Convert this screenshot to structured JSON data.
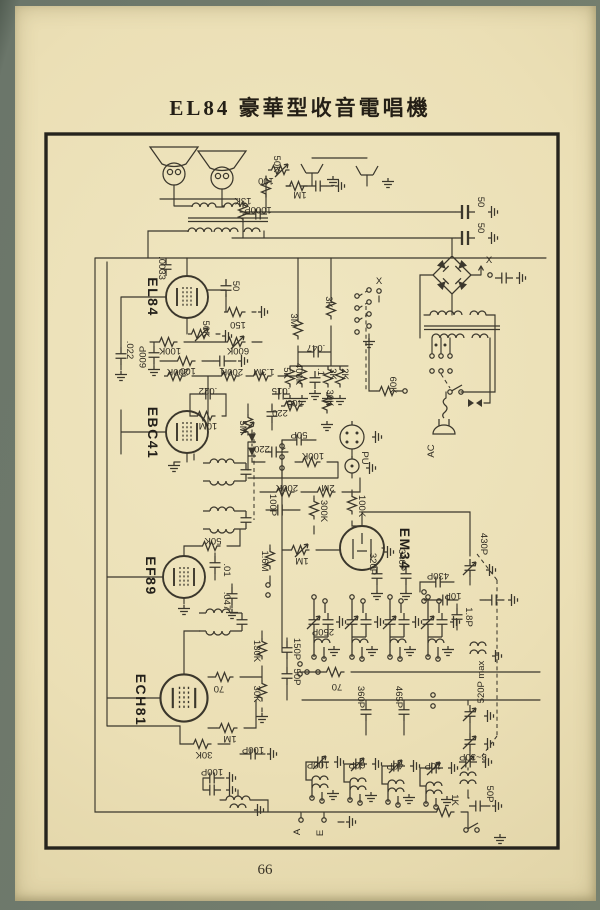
{
  "page": {
    "title": "EL84 豪華型收音電唱機",
    "page_number": "66"
  },
  "colors": {
    "paper": "#ebdfb5",
    "ink": "#3b372c",
    "frame": "#26241d"
  },
  "schematic": {
    "tube_labels": [
      {
        "t": "EL84",
        "x": 148,
        "y": 297
      },
      {
        "t": "EBC41",
        "x": 148,
        "y": 433
      },
      {
        "t": "EF89",
        "x": 146,
        "y": 576
      },
      {
        "t": "ECH81",
        "x": 136,
        "y": 700
      },
      {
        "t": "EM34",
        "x": 400,
        "y": 549
      }
    ],
    "value_labels": [
      {
        "t": "50K",
        "x": 274,
        "y": 164,
        "r": 90
      },
      {
        "t": "100",
        "x": 266,
        "y": 178,
        "r": 180
      },
      {
        "t": "13K",
        "x": 243,
        "y": 198,
        "r": 180
      },
      {
        "t": "1000P",
        "x": 258,
        "y": 207,
        "r": 180
      },
      {
        "t": "1M",
        "x": 300,
        "y": 192,
        "r": 180
      },
      {
        "t": ".0033",
        "x": 159,
        "y": 268,
        "r": 90
      },
      {
        "t": "50",
        "x": 478,
        "y": 202,
        "r": 90
      },
      {
        "t": "50",
        "x": 478,
        "y": 228,
        "r": 90
      },
      {
        "t": "X",
        "x": 489,
        "y": 263,
        "r": 0
      },
      {
        "t": "X",
        "x": 379,
        "y": 284,
        "r": 0
      },
      {
        "t": "AC",
        "x": 434,
        "y": 451,
        "r": -90
      },
      {
        "t": "50",
        "x": 233,
        "y": 286,
        "r": 90
      },
      {
        "t": "150",
        "x": 238,
        "y": 322,
        "r": 180
      },
      {
        "t": "50K",
        "x": 203,
        "y": 329,
        "r": 90
      },
      {
        "t": "100K",
        "x": 170,
        "y": 348,
        "r": 180
      },
      {
        "t": "600K",
        "x": 238,
        "y": 348,
        "r": 180
      },
      {
        "t": ".022",
        "x": 127,
        "y": 350,
        "r": 90
      },
      {
        "t": "600P",
        "x": 146,
        "y": 357,
        "r": -90
      },
      {
        "t": "100",
        "x": 188,
        "y": 368,
        "r": 180
      },
      {
        "t": "1",
        "x": 222,
        "y": 368,
        "r": 180
      },
      {
        "t": "3M",
        "x": 291,
        "y": 320,
        "r": 90
      },
      {
        "t": "3K",
        "x": 326,
        "y": 302,
        "r": 90
      },
      {
        "t": ".047",
        "x": 316,
        "y": 345,
        "r": 180
      },
      {
        "t": "5K",
        "x": 284,
        "y": 373,
        "r": 90
      },
      {
        "t": "400K",
        "x": 296,
        "y": 374,
        "r": 90
      },
      {
        "t": ".1",
        "x": 318,
        "y": 372,
        "r": 90
      },
      {
        "t": "3K",
        "x": 330,
        "y": 374,
        "r": 90
      },
      {
        "t": "2K",
        "x": 342,
        "y": 374,
        "r": 90
      },
      {
        "t": "60K",
        "x": 390,
        "y": 385,
        "r": 90
      },
      {
        "t": "200K",
        "x": 178,
        "y": 369,
        "r": 180
      },
      {
        "t": "200K",
        "x": 232,
        "y": 369,
        "r": 180
      },
      {
        "t": ".022",
        "x": 208,
        "y": 388,
        "r": 180
      },
      {
        "t": "10M",
        "x": 208,
        "y": 423,
        "r": 180
      },
      {
        "t": "1.3M",
        "x": 264,
        "y": 369,
        "r": 180
      },
      {
        "t": "220",
        "x": 280,
        "y": 410,
        "r": 180
      },
      {
        "t": "220",
        "x": 262,
        "y": 446,
        "r": 180
      },
      {
        "t": "5M",
        "x": 240,
        "y": 427,
        "r": 90,
        "fs": 11
      },
      {
        "t": ".015",
        "x": 281,
        "y": 388,
        "r": 180
      },
      {
        "t": "400",
        "x": 295,
        "y": 400,
        "r": 180
      },
      {
        "t": "30K",
        "x": 327,
        "y": 398,
        "r": 90
      },
      {
        "t": "50P",
        "x": 299,
        "y": 432,
        "r": 180
      },
      {
        "t": "100K",
        "x": 313,
        "y": 453,
        "r": 180
      },
      {
        "t": "PU",
        "x": 362,
        "y": 458,
        "r": 90
      },
      {
        "t": "2M",
        "x": 328,
        "y": 485,
        "r": 180
      },
      {
        "t": "200K",
        "x": 287,
        "y": 485,
        "r": 180
      },
      {
        "t": "300K",
        "x": 321,
        "y": 511,
        "r": 90
      },
      {
        "t": "100K",
        "x": 359,
        "y": 506,
        "r": 90
      },
      {
        "t": "100P",
        "x": 270,
        "y": 505,
        "r": 90
      },
      {
        "t": "50K",
        "x": 213,
        "y": 538,
        "r": 180
      },
      {
        "t": "1.6M",
        "x": 262,
        "y": 561,
        "r": 90
      },
      {
        "t": "1M",
        "x": 302,
        "y": 558,
        "r": 180
      },
      {
        "t": ".01",
        "x": 224,
        "y": 570,
        "r": 90
      },
      {
        "t": ".047",
        "x": 224,
        "y": 601,
        "r": 90
      },
      {
        "t": "320P",
        "x": 370,
        "y": 564,
        "r": 90
      },
      {
        "t": "340P",
        "x": 399,
        "y": 560,
        "r": 90
      },
      {
        "t": "430P",
        "x": 481,
        "y": 544,
        "r": 90
      },
      {
        "t": "430P",
        "x": 438,
        "y": 573,
        "r": 180
      },
      {
        "t": "10P",
        "x": 453,
        "y": 593,
        "r": 180
      },
      {
        "t": "1.8P",
        "x": 466,
        "y": 617,
        "r": 90
      },
      {
        "t": "250P",
        "x": 323,
        "y": 629,
        "r": 180
      },
      {
        "t": "130K",
        "x": 254,
        "y": 651,
        "r": 90
      },
      {
        "t": "150P",
        "x": 294,
        "y": 649,
        "r": 90
      },
      {
        "t": "50P",
        "x": 294,
        "y": 677,
        "r": 90
      },
      {
        "t": "70",
        "x": 219,
        "y": 686,
        "r": 180
      },
      {
        "t": "30K",
        "x": 254,
        "y": 694,
        "r": 90
      },
      {
        "t": "1M",
        "x": 230,
        "y": 736,
        "r": 180
      },
      {
        "t": "30K",
        "x": 204,
        "y": 752,
        "r": 180
      },
      {
        "t": "100P",
        "x": 212,
        "y": 769,
        "r": 180
      },
      {
        "t": "100P",
        "x": 253,
        "y": 747,
        "r": 180
      },
      {
        "t": "70",
        "x": 337,
        "y": 684,
        "r": 180
      },
      {
        "t": "360P",
        "x": 358,
        "y": 697,
        "r": 90
      },
      {
        "t": "465P",
        "x": 396,
        "y": 697,
        "r": 90
      },
      {
        "t": "520P max",
        "x": 484,
        "y": 682,
        "r": -90
      },
      {
        "t": "100P",
        "x": 318,
        "y": 762,
        "r": 180
      },
      {
        "t": "60P",
        "x": 357,
        "y": 762,
        "r": 180
      },
      {
        "t": "40P",
        "x": 395,
        "y": 763,
        "r": 180
      },
      {
        "t": "10P",
        "x": 433,
        "y": 763,
        "r": 180
      },
      {
        "t": "3~30P",
        "x": 473,
        "y": 754,
        "r": 180
      },
      {
        "t": "50P",
        "x": 487,
        "y": 794,
        "r": 90
      },
      {
        "t": "1K",
        "x": 452,
        "y": 800,
        "r": 90
      },
      {
        "t": "A",
        "x": 300,
        "y": 832,
        "r": -90
      },
      {
        "t": "E",
        "x": 323,
        "y": 833,
        "r": -90
      }
    ]
  }
}
